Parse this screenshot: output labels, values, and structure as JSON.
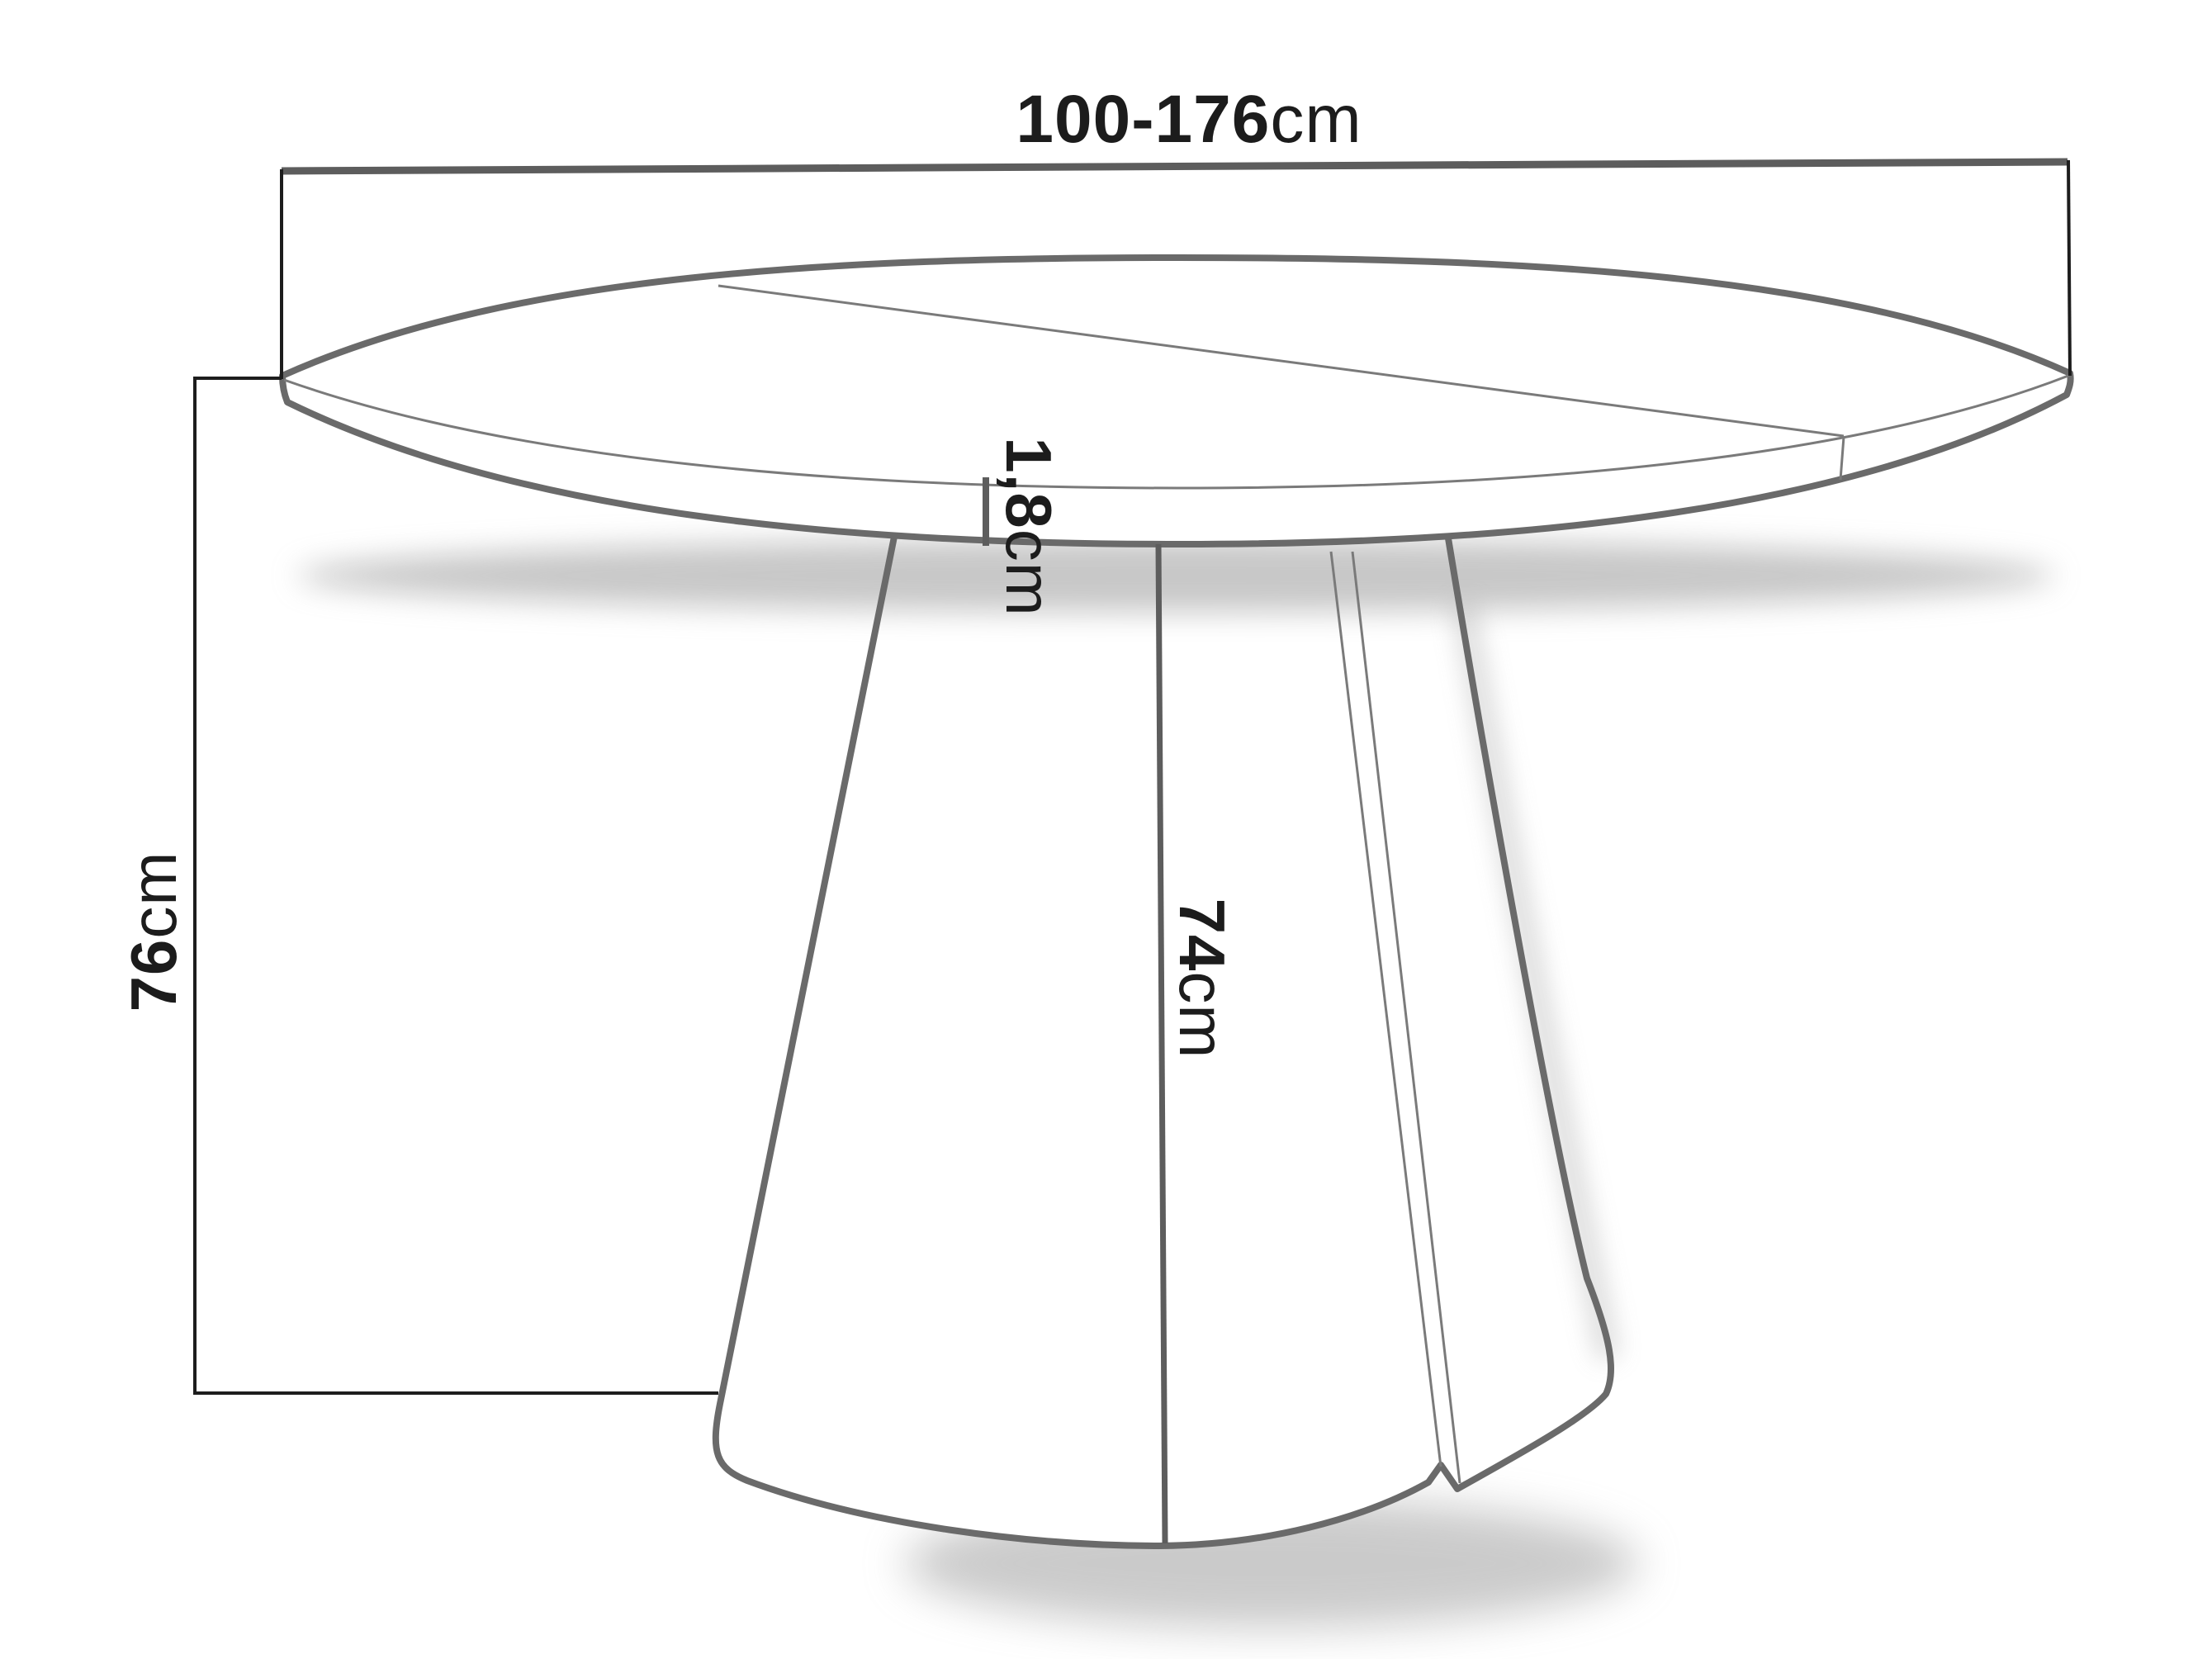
{
  "diagram": {
    "subject": "round pedestal dining table technical drawing",
    "dimensions": {
      "width": {
        "value": "100-176",
        "unit": "cm",
        "meaning": "table top diameter / extended length"
      },
      "height": {
        "value": "76",
        "unit": "cm",
        "meaning": "total table height"
      },
      "thickness": {
        "value": "1,8",
        "unit": "cm",
        "meaning": "table top thickness"
      },
      "leg": {
        "value": "74",
        "unit": "cm",
        "meaning": "pedestal height"
      }
    },
    "colors": {
      "background": "#ffffff",
      "text": "#1c1c1c",
      "outline": "#6a6a6a",
      "outline-thin": "#7a7a7a",
      "dimension": "#1d1d1d",
      "dimension-thick": "#5d5d5d",
      "shadow": "#909090"
    }
  }
}
